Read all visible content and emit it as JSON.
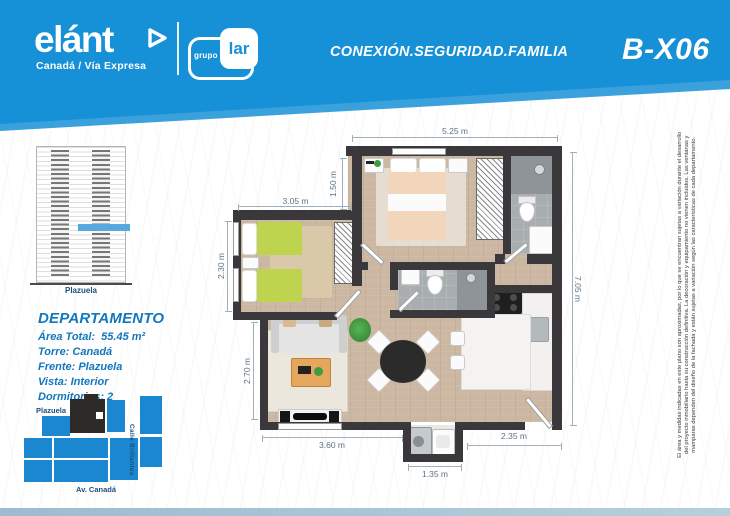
{
  "header": {
    "brand_name": "elánt",
    "brand_tagline": "Canadá / Vía Expresa",
    "partner_small": "grupo",
    "partner_big": "lar",
    "slogan": "CONEXIÓN.SEGURIDAD.FAMILIA",
    "unit_code": "B-X06"
  },
  "elevation": {
    "caption": "Plazuela"
  },
  "apartment": {
    "title": "DEPARTAMENTO",
    "lines": [
      "Área Total:  55.45 m²",
      "Torre: Canadá",
      "Frente: Plazuela",
      "Vista: Interior",
      "Dormitorios: 2"
    ]
  },
  "site_map": {
    "plazuela": "Plazuela",
    "calle": "Calle Brillantes",
    "avenida": "Av. Canadá"
  },
  "floor_plan": {
    "dimensions": {
      "top": "5.25 m",
      "master_depth": "1.50 m",
      "bedroom2_width": "3.05 m",
      "bedroom2_depth": "2.30 m",
      "living_depth": "2.70 m",
      "living_width": "3.60 m",
      "laundry_width": "1.35 m",
      "terrace_width": "2.35 m",
      "right_height": "7.05 m"
    }
  },
  "disclaimer": {
    "lines": [
      "El área y medidas indicadas en este plano son aproximadas, por lo que se encuentran sujetas a variación durante el desarrollo",
      "del proyecto inmobiliario hasta su construcción definitiva. La decoración y equipamiento no vienen incluidos. Las ventanas y",
      "mamparas dependen del diseño de la fachada y están sujetas a variación según las características de cada departamento."
    ]
  },
  "colors": {
    "brand_blue": "#1690d6",
    "map_blue": "#1b87d1",
    "wall": "#3a383a",
    "wood_floor": "#ccb8a2",
    "bath_gray": "#a8adb0",
    "bed_green": "#bfd44e",
    "duvet_peach": "#f1d6bb",
    "info_text_blue": "#1277bd",
    "dim_text": "#5d7285"
  }
}
